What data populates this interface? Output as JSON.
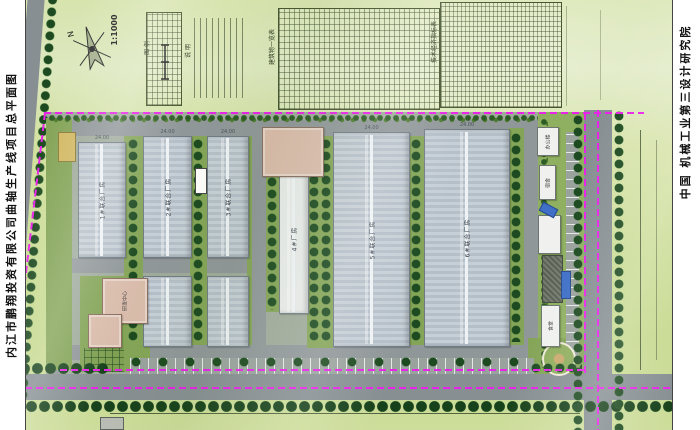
{
  "drawing": {
    "left_title": "内江市鹏翔投资有限公司曲轴生产线项目总平面图",
    "right_title": "中国  机械工业第三设计研究院",
    "north_label": "N",
    "scale_label": "1:1000"
  },
  "legend": {
    "title": "图 例"
  },
  "notes": {
    "title": "说 明"
  },
  "tables": {
    "table1_title": "建筑物一览表",
    "table2_title": "技术经济指标表"
  },
  "dims": {
    "hall_width": "24.00"
  },
  "buildings": {
    "hall1": "1#联合厂房",
    "hall2": "2#联合厂房",
    "hall3": "3#联合厂房",
    "hall4": "4#厂房",
    "hall5": "5#联合厂房",
    "hall6": "6#联合厂房",
    "rnd": "研发中心",
    "office": "办公楼",
    "dorm": "宿舍",
    "canteen": "食堂"
  },
  "colors": {
    "boundary_magenta": "#e822e8",
    "road_gray": "#878f92",
    "hall_fill": "#bfc9d1",
    "tree_green": "#1d4a20",
    "site_grass": "#84a457",
    "outer_green": "#d2e09f",
    "pink_building": "#d9bcab"
  }
}
